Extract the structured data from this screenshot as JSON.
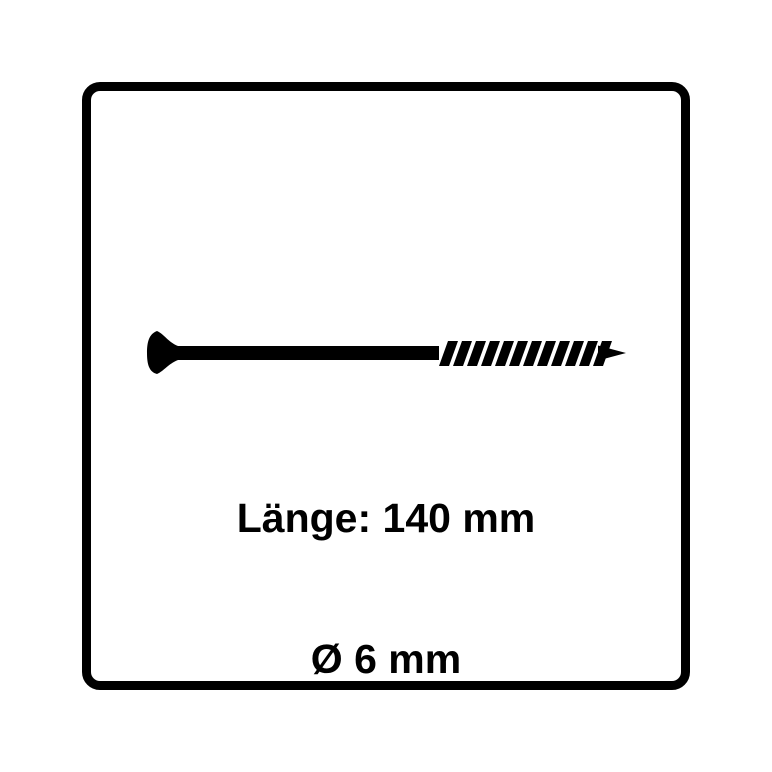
{
  "product_diagram": {
    "illustration": "screw-side-view",
    "length_label": "Länge: 140 mm",
    "diameter_label": "Ø 6 mm"
  },
  "screw": {
    "head_type": "countersunk",
    "thread_section": "partial-right",
    "tip": "pointed"
  },
  "colors": {
    "ink": "#000000",
    "background": "#ffffff"
  }
}
